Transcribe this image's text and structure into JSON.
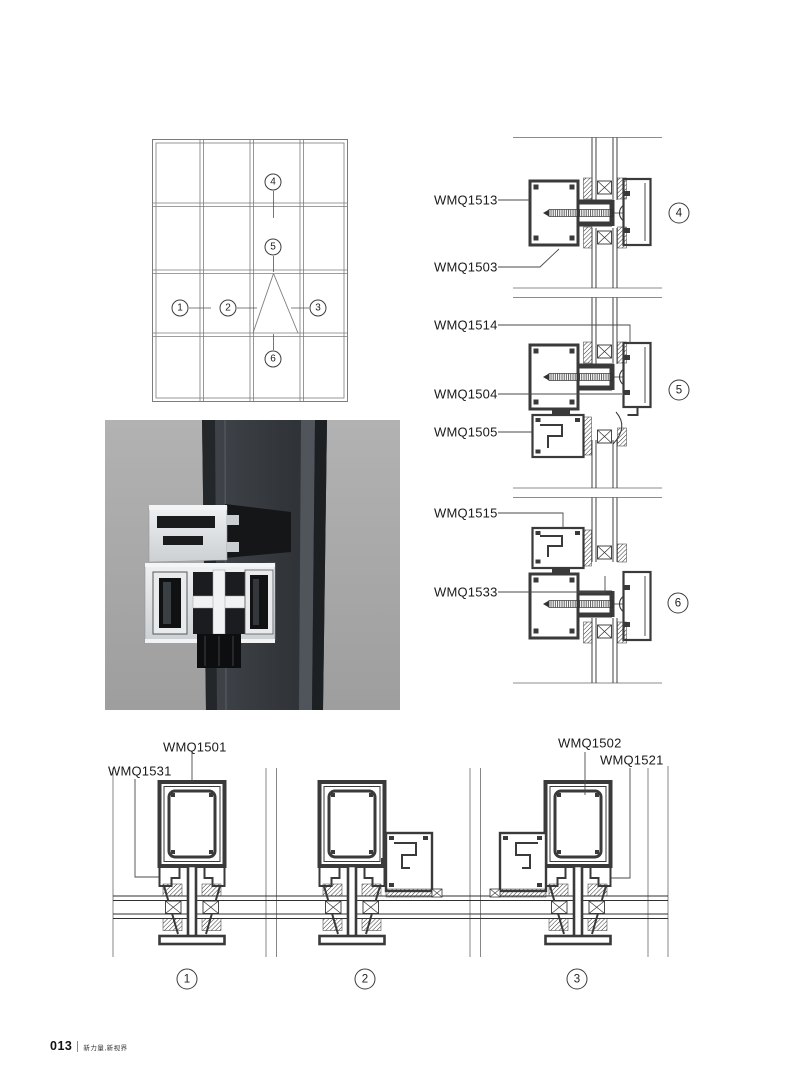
{
  "labels": {
    "wmq1513": "WMQ1513",
    "wmq1503": "WMQ1503",
    "wmq1514": "WMQ1514",
    "wmq1504": "WMQ1504",
    "wmq1505": "WMQ1505",
    "wmq1515": "WMQ1515",
    "wmq1533": "WMQ1533",
    "wmq1501": "WMQ1501",
    "wmq1531": "WMQ1531",
    "wmq1502": "WMQ1502",
    "wmq1521": "WMQ1521"
  },
  "callouts": {
    "c1": "1",
    "c2": "2",
    "c3": "3",
    "c4": "4",
    "c5": "5",
    "c6": "6",
    "s4": "4",
    "s5": "5",
    "s6": "6",
    "b1": "1",
    "b2": "2",
    "b3": "3"
  },
  "footer": {
    "page_number": "013",
    "slogan": "新力量,新视界"
  },
  "colors": {
    "paper": "#ffffff",
    "ink_text": "#1a1a1a",
    "profile_ink": "#3a3a3a",
    "grid_gray": "#7d7d7d",
    "render_bg": "#a9a9a9",
    "glass_dark": "#34383d",
    "aluminum": "#e7e9eb"
  }
}
